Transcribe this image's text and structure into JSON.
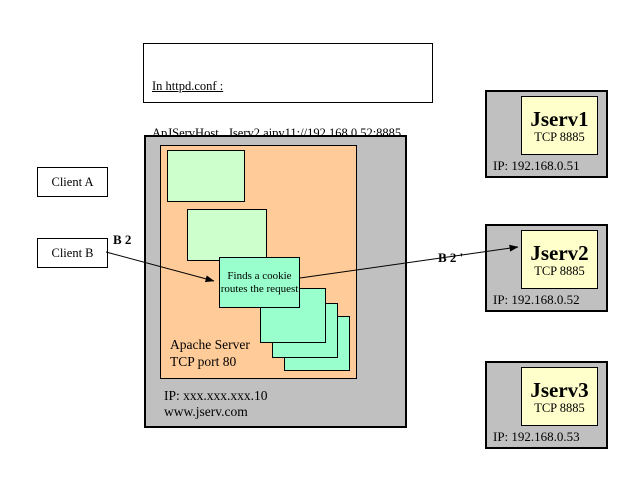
{
  "config": {
    "title": "In httpd.conf :",
    "host_line": "ApJServHost   Jserv2 ajpv11://192.168.0.52:8885",
    "route_line": "ApJServRoute JS2 Jserv2"
  },
  "clients": {
    "a_label": "Client A",
    "b_label": "Client B"
  },
  "flow": {
    "request_label": "B 2",
    "routed_label": "B 2 '"
  },
  "apache": {
    "cookie_line1": "Finds a cookie",
    "cookie_line2": "routes the request",
    "title_line1": "Apache Server",
    "title_line2": "TCP port 80",
    "ip": "IP: xxx.xxx.xxx.10",
    "host": "www.jserv.com"
  },
  "jservs": [
    {
      "name": "Jserv1",
      "port": "TCP 8885",
      "ip": "IP: 192.168.0.51"
    },
    {
      "name": "Jserv2",
      "port": "TCP 8885",
      "ip": "IP: 192.168.0.52"
    },
    {
      "name": "Jserv3",
      "port": "TCP 8885",
      "ip": "IP: 192.168.0.53"
    }
  ],
  "colors": {
    "panel_gray": "#c0c0c0",
    "apache_orange": "#ffcc99",
    "module_green": "#ccffcc",
    "request_aqua": "#99ffcc",
    "jserv_yellow": "#ffffcc"
  }
}
